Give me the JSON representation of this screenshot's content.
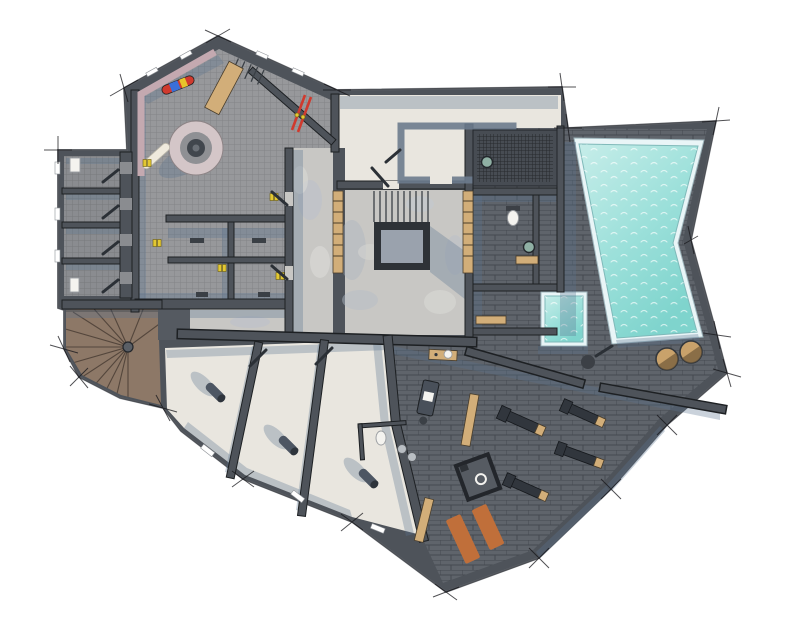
{
  "scene": {
    "label": "Architectural floor plan, top-down 3D render of a chalet spa and wellness basement level with swimming pool, gym, ski room and relaxation rooms",
    "view": "top-down",
    "style": "rendered color floor plan on white background with surveyor tick marks at wall corners"
  },
  "colors": {
    "background": "#ffffff",
    "wall": "#4e535a",
    "wall_edge": "#1d2023",
    "tile": "#97989b",
    "tile_dark": "#8a8c90",
    "concrete": "#c8c7c4",
    "cream": "#e9e6df",
    "brick": "#5f646b",
    "wood": "#8d7867",
    "wood_bench": "#d2ae79",
    "pool_water": "#9ce0da",
    "pool_water_light": "#c6ede9",
    "pool_water_deep": "#7fd4cd",
    "pool_coping": "#e9f5f7",
    "shadow": "#5b7390",
    "mat": "#c06f3a",
    "tub": "#c9a26b",
    "cylinder": "#4d5663",
    "machine": "#31363d",
    "boot": "#e3c832",
    "ski_red": "#d03a2e",
    "board_blue": "#3a6fd8",
    "board_yellow": "#e8c42a",
    "bench_pink": "#c4a9b0",
    "fixture": "#8fb0a4",
    "void": "#2e3237",
    "void_inner": "#9aa2ad",
    "grate": "#42474e"
  },
  "rooms": [
    {
      "name": "ski-room",
      "floor": "tile"
    },
    {
      "name": "storage-cellars",
      "floor": "tile_dark",
      "count": 4
    },
    {
      "name": "changing-cubicles",
      "floor": "tile",
      "count": 4
    },
    {
      "name": "corridor",
      "floor": "concrete"
    },
    {
      "name": "stair-hall",
      "floor": "concrete"
    },
    {
      "name": "upper-room",
      "floor": "cream"
    },
    {
      "name": "shower-room",
      "floor": "grate"
    },
    {
      "name": "spa-wc",
      "floor": "brick"
    },
    {
      "name": "sauna",
      "floor": "brick"
    },
    {
      "name": "pool-deck",
      "floor": "brick"
    },
    {
      "name": "swimming-pool",
      "floor": "pool_water"
    },
    {
      "name": "plunge-pool",
      "floor": "pool_water"
    },
    {
      "name": "gym",
      "floor": "brick"
    },
    {
      "name": "massage-area",
      "floor": "brick"
    },
    {
      "name": "relax-rooms",
      "floor": "cream",
      "count": 3
    },
    {
      "name": "spiral-stair-room",
      "floor": "wood"
    },
    {
      "name": "lower-wc",
      "floor": "cream"
    }
  ],
  "furniture": {
    "snowboards": 2,
    "ski_pairs": 1,
    "boot_pairs": 5,
    "round_boot_dryer": 1,
    "wall_bench_pink": 1,
    "wooden_benches": 5,
    "stair_flights": 2,
    "spiral_staircase": 1,
    "floor_opening": 1,
    "loungers": 3,
    "toilets": 2,
    "sinks": 2,
    "massage_tables": 1,
    "gym_machines": 4,
    "yoga_mats": 2,
    "shower_cubicle": 1,
    "wooden_round_tubs": 2
  }
}
